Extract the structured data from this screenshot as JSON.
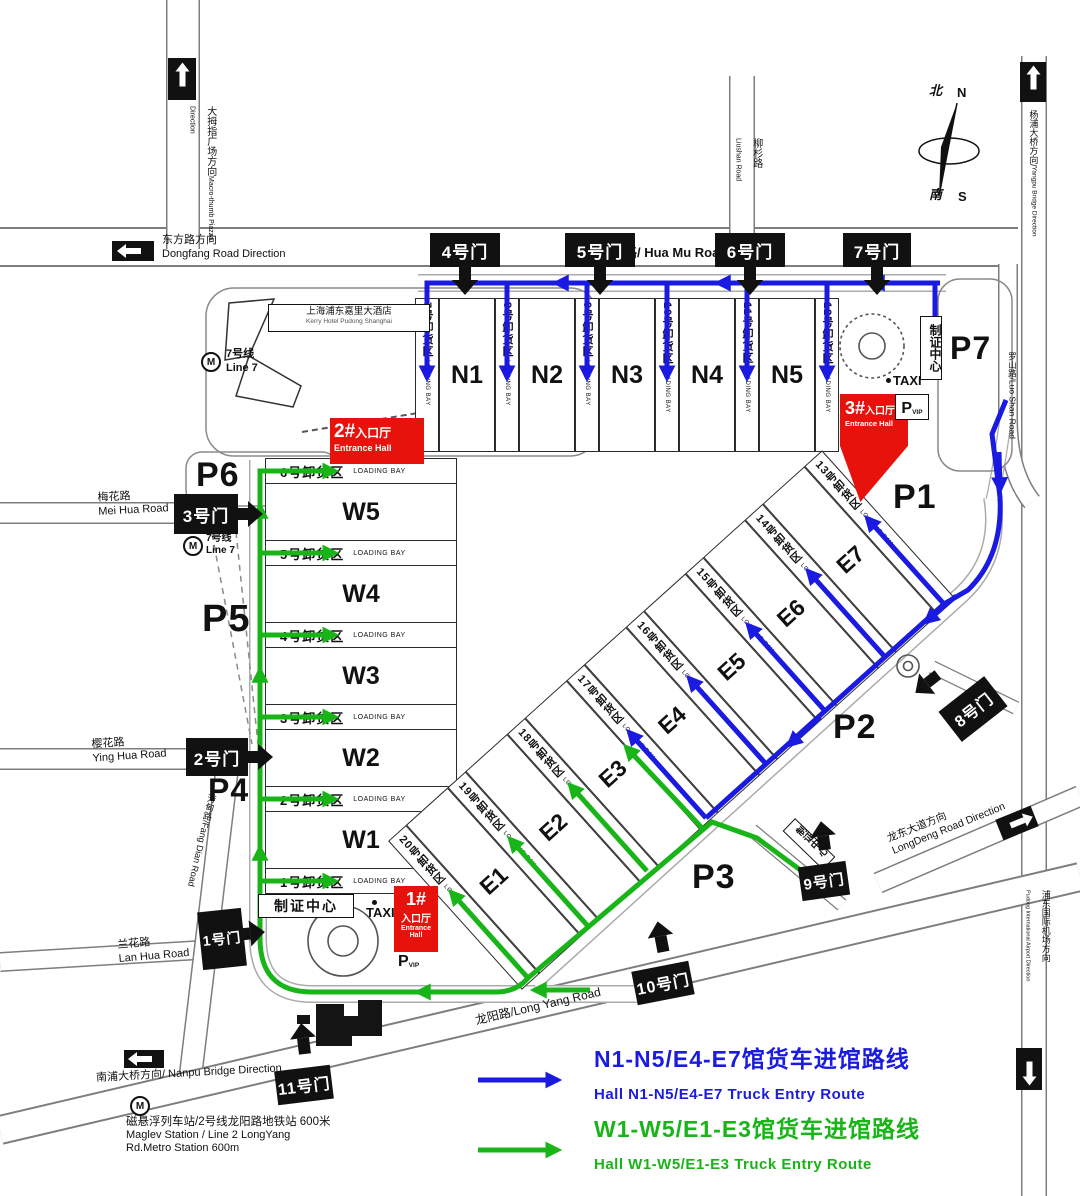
{
  "colors": {
    "route_blue": "#1a1ae0",
    "route_green": "#18b418",
    "entrance_red": "#e8120c",
    "gate_black": "#111111"
  },
  "legend": {
    "blue_cn": "N1-N5/E4-E7馆货车进馆路线",
    "blue_en": "Hall N1-N5/E4-E7 Truck Entry Route",
    "green_cn": "W1-W5/E1-E3馆货车进馆路线",
    "green_en": "Hall W1-W5/E1-E3 Truck Entry Route"
  },
  "gates": [
    "1号门",
    "2号门",
    "3号门",
    "4号门",
    "5号门",
    "6号门",
    "7号门",
    "8号门",
    "9号门",
    "10号门",
    "11号门"
  ],
  "halls": {
    "n": [
      "N1",
      "N2",
      "N3",
      "N4",
      "N5"
    ],
    "w": [
      "W5",
      "W4",
      "W3",
      "W2",
      "W1"
    ],
    "e": [
      "E1",
      "E2",
      "E3",
      "E4",
      "E5",
      "E6",
      "E7"
    ]
  },
  "bays": [
    "1号卸货区",
    "2号卸货区",
    "3号卸货区",
    "4号卸货区",
    "5号卸货区",
    "6号卸货区",
    "7号卸货区",
    "8号卸货区",
    "9号卸货区",
    "10号卸货区",
    "11号卸货区",
    "12号卸货区",
    "13号卸货区",
    "14号卸货区",
    "15号卸货区",
    "16号卸货区",
    "17号卸货区",
    "18号卸货区",
    "19号卸货区",
    "20号卸货区"
  ],
  "parking": [
    "P1",
    "P2",
    "P3",
    "P4",
    "P5",
    "P6",
    "P7"
  ],
  "entrance": {
    "n1": "1#",
    "n2": "2#",
    "n3": "3#",
    "cn": "入口厅",
    "en": "Entrance Hall"
  },
  "labels": {
    "loading_bay": "LOADING BAY",
    "taxi": "TAXI",
    "p": "P",
    "vip": "VIP",
    "badge_center": "制证中心",
    "north_cn": "北",
    "north_en": "N",
    "south_cn": "南",
    "south_en": "S"
  },
  "roads": {
    "huamu": "花木路/ Hua Mu Road",
    "liushan_cn": "柳杉路",
    "liushan_en": "Liushan Road",
    "dongfang_cn": "东方路方向",
    "dongfang_en": "Dongfang Road Direction",
    "macrothumb_cn": "大拇指广场方向",
    "macrothumb_en": "Macro-thumb Piazza Direction",
    "yangpu_cn": "杨浦大桥方向/",
    "yangpu_en": "Yangpu Bridge Direction",
    "luoshan": "罗山路/Luo Shan Road",
    "meihua_cn": "梅花路",
    "meihua_en": "Mei Hua Road",
    "yinghua_cn": "樱花路",
    "yinghua_en": "Ying Hua Road",
    "lanhua_cn": "兰花路",
    "lanhua_en": "Lan Hua Road",
    "fangdian": "芳甸路/Fang Dian Road",
    "longyang": "龙阳路/Long Yang Road",
    "nanpu": "南浦大桥方向/ Nanpu Bridge Direction",
    "longdeng_cn": "龙东大道方向",
    "longdeng_en": "LongDeng Road Direction",
    "airport_cn": "浦东国际机场方向",
    "airport_en": "Pudong International Airport Direction"
  },
  "transit": {
    "line7_cn": "7号线",
    "line7_en": "Line 7",
    "maglev_cn": "磁悬浮列车站/2号线龙阳路地铁站  600米",
    "maglev_en1": "Maglev Station / Line 2 LongYang",
    "maglev_en2": "Rd.Metro Station 600m"
  },
  "hotel": {
    "cn": "上海浦东嘉里大酒店",
    "en": "Kerry Hotel Pudong Shanghai"
  }
}
